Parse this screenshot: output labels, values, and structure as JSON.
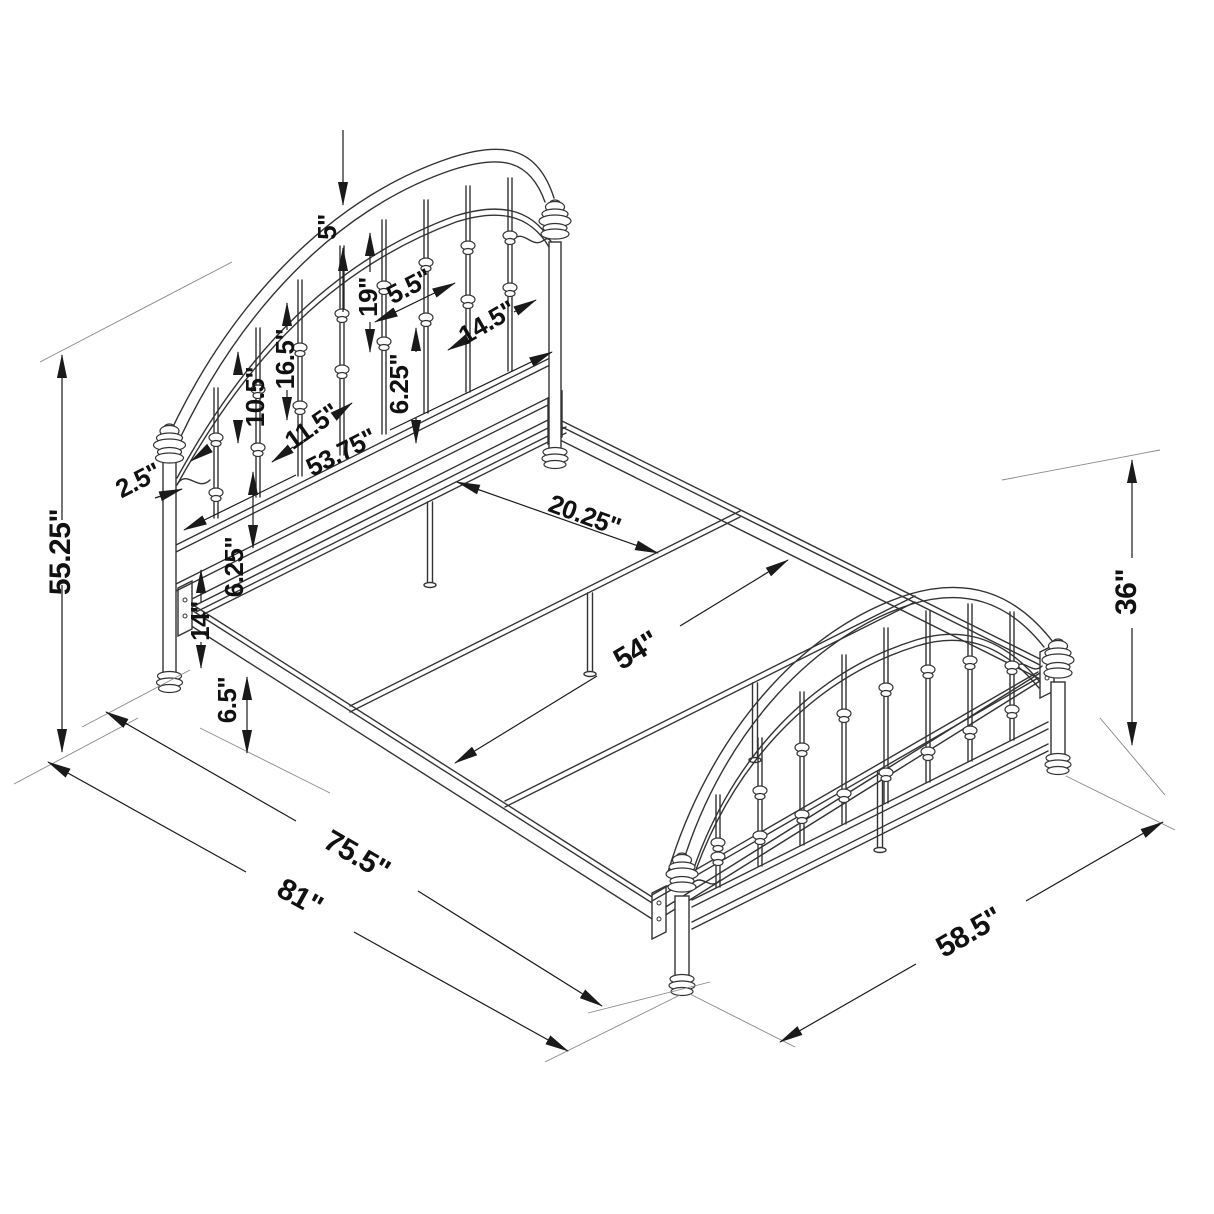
{
  "figure": {
    "type": "isometric line drawing",
    "subject": "metal panel bed frame with arched headboard, arched footboard and slat support frame",
    "background": "#ffffff",
    "line_color": "#333333",
    "dimension_color": "#1a1a1a"
  },
  "dims": {
    "headboard_height": "55.25\"",
    "arch_rail_gap": "5\"",
    "long_spindle": "19\"",
    "spindle_spacing": "5.5\"",
    "headboard_side_rail": "14.5\"",
    "mid_spindle": "16.5\"",
    "short_spindle": "10.5\"",
    "headboard_rail_gap": "6.25\"",
    "headboard_scroll_width": "11.5\"",
    "headboard_width": "53.75\"",
    "post_diameter": "2.5\"",
    "slat_spacing": "20.25\"",
    "lower_rail_gap": "6.25\"",
    "rail_floor_height": "14\"",
    "frame_inner_width": "54\"",
    "footboard_height": "36\"",
    "rail_section_height": "6.5\"",
    "frame_length": "75.5\"",
    "overall_length": "81\"",
    "footboard_width": "58.5\""
  }
}
